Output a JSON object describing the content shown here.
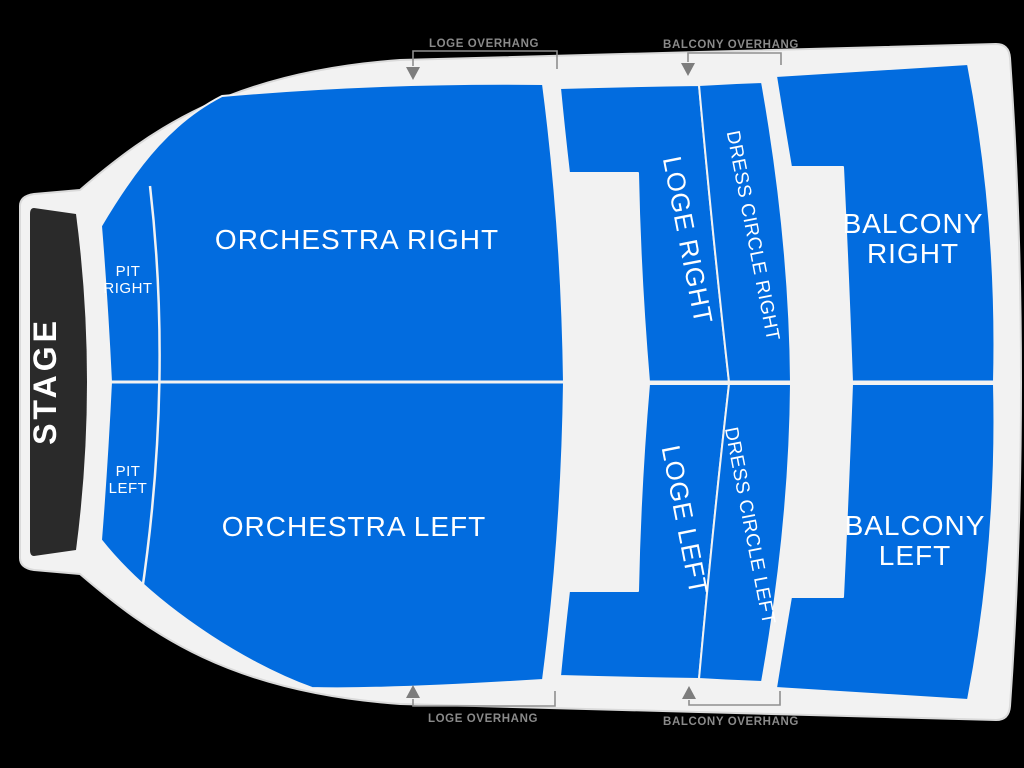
{
  "colors": {
    "background": "#000000",
    "floor": "#f2f2f2",
    "section_blue": "#026cdf",
    "stage_black": "#2a2a2a",
    "label_white": "#ffffff",
    "annotation_gray": "#8a8a8a"
  },
  "stage": {
    "label": "STAGE"
  },
  "sections": {
    "pit_right": {
      "lines": [
        "PIT",
        "RIGHT"
      ]
    },
    "pit_left": {
      "lines": [
        "PIT",
        "LEFT"
      ]
    },
    "orchestra_right": {
      "label": "ORCHESTRA RIGHT"
    },
    "orchestra_left": {
      "label": "ORCHESTRA LEFT"
    },
    "loge_right": {
      "label": "LOGE RIGHT"
    },
    "loge_left": {
      "label": "LOGE LEFT"
    },
    "dress_circle_right": {
      "label": "DRESS CIRCLE RIGHT"
    },
    "dress_circle_left": {
      "label": "DRESS CIRCLE LEFT"
    },
    "balcony_right": {
      "lines": [
        "BALCONY",
        "RIGHT"
      ]
    },
    "balcony_left": {
      "lines": [
        "BALCONY",
        "LEFT"
      ]
    }
  },
  "annotations": {
    "loge_overhang_top": "LOGE OVERHANG",
    "balcony_overhang_top": "BALCONY OVERHANG",
    "loge_overhang_bottom": "LOGE OVERHANG",
    "balcony_overhang_bottom": "BALCONY OVERHANG"
  }
}
